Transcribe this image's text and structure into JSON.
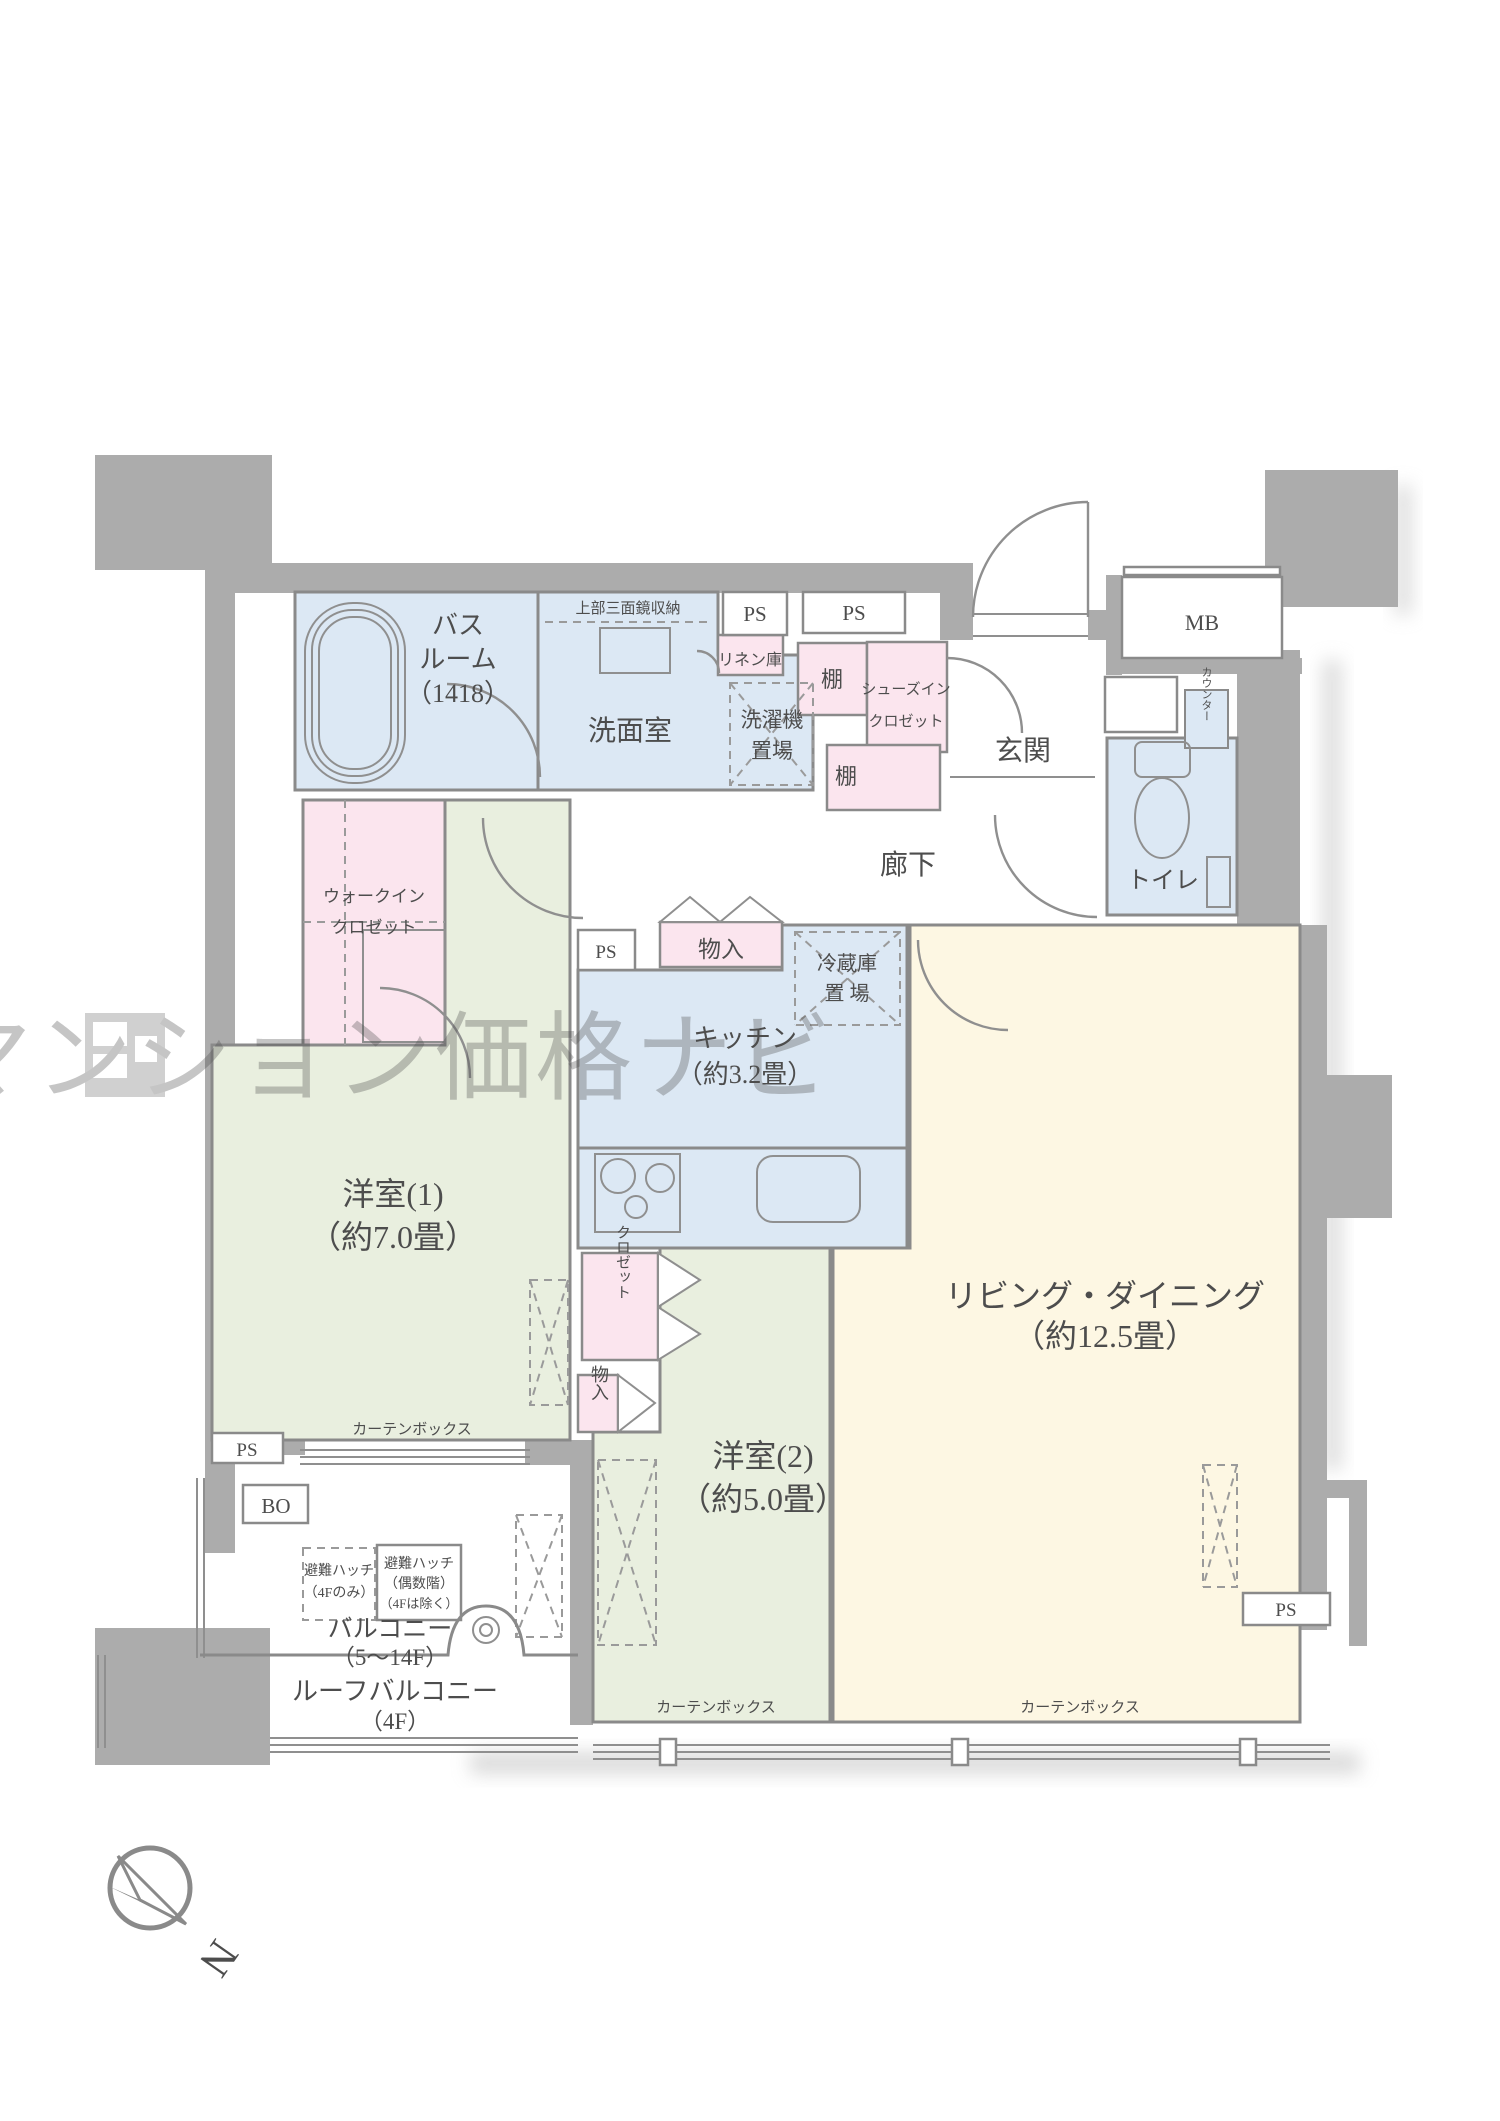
{
  "colors": {
    "wall": "#acacac",
    "water": "#dce8f4",
    "pink": "#fbe5ee",
    "green": "#e9efdf",
    "cream": "#fdf7e3",
    "line": "#8a8a8a",
    "text": "#4d4d4d",
    "watermark": "#8f8f8f"
  },
  "plan": {
    "bathroom": [
      "バス",
      "ルーム",
      "（1418）"
    ],
    "mirror_storage": "上部三面鏡収納",
    "washroom": "洗面室",
    "laundry": [
      "洗濯機",
      "置場"
    ],
    "linen": "リネン庫",
    "ps": "PS",
    "shelf": "棚",
    "sic": [
      "シューズイン",
      "クロゼット"
    ],
    "entrance": "玄関",
    "mb": "MB",
    "counter": "カウンター",
    "toilet": "トイレ",
    "hallway": "廊下",
    "wic": [
      "ウォークイン",
      "クロゼット"
    ],
    "storage": "物入",
    "fridge": [
      "冷蔵庫",
      "置 場"
    ],
    "kitchen": [
      "キッチン",
      "（約3.2畳）"
    ],
    "room1": [
      "洋室(1)",
      "（約7.0畳）"
    ],
    "room2": [
      "洋室(2)",
      "（約5.0畳）"
    ],
    "living": [
      "リビング・ダイニング",
      "（約12.5畳）"
    ],
    "curtain_box": "カーテンボックス",
    "bo": "BO",
    "closet": "クロゼット",
    "balcony": [
      "バルコニー",
      "（5〜14F）"
    ],
    "roof_balcony": [
      "ルーフバルコニー",
      "（4F）"
    ],
    "hatch_4f": [
      "避難ハッチ",
      "（4Fのみ）"
    ],
    "hatch_even": [
      "避難ハッチ",
      "（偶数階）",
      "（4Fは除く）"
    ]
  },
  "watermark": {
    "text": "湾岸中古マンション価格ナビ"
  },
  "compass": {
    "north": "N"
  }
}
